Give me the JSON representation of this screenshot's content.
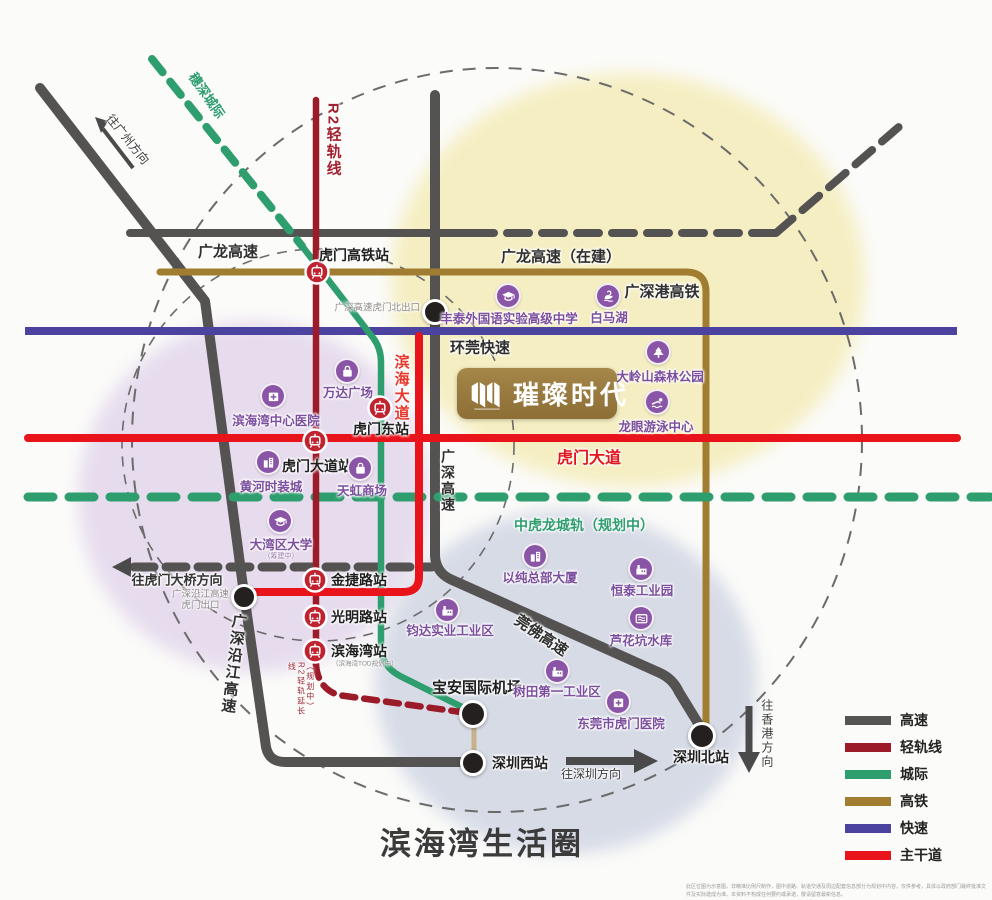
{
  "title": "滨海湾生活圈",
  "project": {
    "name": "璀璨时代"
  },
  "disclaimer": "此区位图为示意图，非精准比例尺制作，图中道路、轨道交通及周边配套信息部分为规划中内容，仅供参考，具体以政府部门最终批准文件及实际建成为准。本资料不构成任何要约或承诺，敬请留意最新信息。",
  "colors": {
    "highway": "#555252",
    "light_rail": "#9c1b29",
    "intercity": "#2e9e6e",
    "hsr": "#a07d30",
    "expressway": "#4c43a0",
    "arterial": "#e8131b",
    "poi": "#8a55a6",
    "poi_label": "#7b4e9e"
  },
  "road_labels": [
    {
      "id": "guanglong-expwy",
      "text": "广龙高速",
      "x": 228,
      "y": 252,
      "size": 15,
      "weight": "bold",
      "color": "#2f2f2f"
    },
    {
      "id": "guanglong-expwy-uc",
      "text": "广龙高速（在建）",
      "x": 561,
      "y": 257,
      "size": 15,
      "weight": "bold",
      "color": "#2f2f2f"
    },
    {
      "id": "r2-light-rail",
      "text": "R2轻轨线",
      "x": 333,
      "y": 140,
      "size": 15,
      "weight": "bold",
      "color": "#a3202e",
      "vertical": true
    },
    {
      "id": "suishen-intercity",
      "text": "穗深城际",
      "x": 206,
      "y": 96,
      "size": 13,
      "weight": "bold",
      "color": "#2f9e6e",
      "rot": 55
    },
    {
      "id": "to-guangzhou",
      "text": "往广州方向",
      "x": 127,
      "y": 140,
      "size": 12,
      "weight": "normal",
      "color": "#3c3c3c",
      "rot": 51
    },
    {
      "id": "huanwan-expwy",
      "text": "环莞快速",
      "x": 480,
      "y": 348,
      "size": 15,
      "weight": "bold",
      "color": "#2f2f2f"
    },
    {
      "id": "binhai-avenue",
      "text": "滨海大道",
      "x": 401,
      "y": 388,
      "size": 15,
      "weight": "bold",
      "color": "#e8362b",
      "vertical": true
    },
    {
      "id": "humen-avenue",
      "text": "虎门大道",
      "x": 589,
      "y": 459,
      "size": 16,
      "weight": "bold",
      "color": "#e0161c"
    },
    {
      "id": "guangshen-expwy",
      "text": "广深高速",
      "x": 448,
      "y": 481,
      "size": 14,
      "weight": "bold",
      "color": "#2f2f2f",
      "vertical": true
    },
    {
      "id": "zhonghulong-rail",
      "text": "中虎龙城轨（规划中）",
      "x": 584,
      "y": 525,
      "size": 14,
      "weight": "bold",
      "color": "#2f9e6e"
    },
    {
      "id": "guanfo-expwy",
      "text": "莞佛高速",
      "x": 541,
      "y": 636,
      "size": 15,
      "weight": "bold",
      "color": "#2f2f2f",
      "rot": 34
    },
    {
      "id": "yanjiang-expwy",
      "text": "广深沿江高速",
      "x": 233,
      "y": 664,
      "size": 15,
      "weight": "bold",
      "color": "#2f2f2f",
      "vertical": true,
      "rot": 7
    },
    {
      "id": "to-humen-bridge",
      "text": "往虎门大桥方向",
      "x": 177,
      "y": 581,
      "size": 13,
      "weight": "bold",
      "color": "#333333"
    },
    {
      "id": "to-shenzhen",
      "text": "往深圳方向",
      "x": 591,
      "y": 775,
      "size": 12,
      "weight": "normal",
      "color": "#3c3c3c"
    },
    {
      "id": "to-hongkong",
      "text": "往香港方向",
      "x": 766,
      "y": 734,
      "size": 12,
      "weight": "normal",
      "color": "#3c3c3c",
      "vertical": true
    },
    {
      "id": "guangshengang-hsr",
      "text": "广深港高铁",
      "x": 662,
      "y": 292,
      "size": 15,
      "weight": "bold",
      "color": "#2f2f2f"
    },
    {
      "id": "r2-extension",
      "text": "（规划中）R2轻轨延长线",
      "x": 301,
      "y": 690,
      "size": 8,
      "weight": "normal",
      "color": "#9c2733",
      "vertical": true,
      "h": 56
    }
  ],
  "stations": [
    {
      "id": "humen-hsr-station",
      "label": "虎门高铁站",
      "x": 317,
      "y": 272,
      "lx": 354,
      "ly": 255,
      "anchor": "c"
    },
    {
      "id": "humen-east-station",
      "label": "虎门东站",
      "x": 380,
      "y": 408,
      "lx": 381,
      "ly": 429,
      "anchor": "c"
    },
    {
      "id": "humen-avenue-station",
      "label": "虎门大道站",
      "x": 315,
      "y": 441,
      "lx": 317,
      "ly": 466,
      "anchor": "c"
    },
    {
      "id": "jinjie-road-station",
      "label": "金捷路站",
      "x": 315,
      "y": 580,
      "lx": 331,
      "ly": 580,
      "anchor": "l"
    },
    {
      "id": "guangming-road-station",
      "label": "光明路站",
      "x": 315,
      "y": 617,
      "lx": 331,
      "ly": 617,
      "anchor": "l"
    },
    {
      "id": "binhaiwan-station",
      "label": "滨海湾站",
      "x": 315,
      "y": 651,
      "lx": 331,
      "ly": 651,
      "anchor": "l",
      "sub": "（滨海湾TOD规划中）",
      "sx": 332,
      "sy": 664
    }
  ],
  "markers": [
    {
      "id": "humen-north-exit",
      "label": "广深高速虎门北出口",
      "x": 435,
      "y": 312,
      "r": 13,
      "lx": 420,
      "ly": 309,
      "anchor": "r",
      "lsize": 9.5,
      "lcolor": "#8f8b8b",
      "lweight": "normal"
    },
    {
      "id": "yanjiang-humen-exit",
      "label": "广深沿江高速\n虎门出口",
      "x": 244,
      "y": 597,
      "r": 13,
      "lx": 229,
      "ly": 601,
      "anchor": "r",
      "lsize": 9.5,
      "lcolor": "#8f8b8b",
      "lweight": "normal",
      "center": true
    },
    {
      "id": "baoan-airport",
      "label": "宝安国际机场",
      "x": 473,
      "y": 714,
      "r": 14,
      "lx": 477,
      "ly": 688,
      "anchor": "c",
      "lsize": 15,
      "lcolor": "#1e1e1e",
      "lweight": "bold"
    },
    {
      "id": "shenzhen-west-station",
      "label": "深圳西站",
      "x": 473,
      "y": 763,
      "r": 13,
      "lx": 492,
      "ly": 763,
      "anchor": "l",
      "lsize": 14,
      "lcolor": "#1e1e1e",
      "lweight": "bold"
    },
    {
      "id": "shenzhen-north-station",
      "label": "深圳北站",
      "x": 702,
      "y": 736,
      "r": 14,
      "lx": 701,
      "ly": 757,
      "anchor": "c",
      "lsize": 14,
      "lcolor": "#1e1e1e",
      "lweight": "bold"
    }
  ],
  "pois": [
    {
      "id": "fengtai-school",
      "icon": "school",
      "label": "丰泰外国语实验高级中学",
      "x": 508,
      "y": 296,
      "lx": 509,
      "ly": 319
    },
    {
      "id": "baimahu-lake",
      "icon": "bird",
      "label": "白马湖",
      "x": 608,
      "y": 296,
      "lx": 609,
      "ly": 318
    },
    {
      "id": "dalingshan-park",
      "icon": "tree",
      "label": "大岭山森林公园",
      "x": 658,
      "y": 352,
      "lx": 660,
      "ly": 377
    },
    {
      "id": "longyan-swim-center",
      "icon": "swimmer",
      "label": "龙眼游泳中心",
      "x": 657,
      "y": 402,
      "lx": 656,
      "ly": 427
    },
    {
      "id": "wanda-plaza",
      "icon": "bag",
      "label": "万达广场",
      "x": 347,
      "y": 371,
      "lx": 348,
      "ly": 393
    },
    {
      "id": "binhaiwan-hospital",
      "icon": "hospital",
      "label": "滨海湾中心医院",
      "x": 273,
      "y": 396,
      "lx": 276,
      "ly": 421
    },
    {
      "id": "huanghe-fashion-city",
      "icon": "building",
      "label": "黄河时装城",
      "x": 268,
      "y": 462,
      "lx": 271,
      "ly": 487
    },
    {
      "id": "tianhong-mall",
      "icon": "bag",
      "label": "天虹商场",
      "x": 360,
      "y": 468,
      "lx": 362,
      "ly": 491
    },
    {
      "id": "greater-bay-university",
      "icon": "school",
      "label": "大湾区大学",
      "x": 280,
      "y": 521,
      "lx": 281,
      "ly": 545,
      "sub": "（筹建中）",
      "sx": 281,
      "sy": 557
    },
    {
      "id": "yichun-hq-tower",
      "icon": "building",
      "label": "以纯总部大厦",
      "x": 535,
      "y": 556,
      "lx": 540,
      "ly": 578
    },
    {
      "id": "hengtai-industrial-park",
      "icon": "factory",
      "label": "恒泰工业园",
      "x": 641,
      "y": 569,
      "lx": 642,
      "ly": 591
    },
    {
      "id": "luhuakeng-reservoir",
      "icon": "water",
      "label": "芦花坑水库",
      "x": 641,
      "y": 618,
      "lx": 641,
      "ly": 641
    },
    {
      "id": "junda-industrial-zone",
      "icon": "factory",
      "label": "钧达实业工业区",
      "x": 447,
      "y": 610,
      "lx": 450,
      "ly": 631
    },
    {
      "id": "shutian-first-industrial-zone",
      "icon": "factory",
      "label": "树田第一工业区",
      "x": 557,
      "y": 671,
      "lx": 557,
      "ly": 692
    },
    {
      "id": "dongguan-humen-hospital",
      "icon": "hospital",
      "label": "东莞市虎门医院",
      "x": 618,
      "y": 702,
      "lx": 621,
      "ly": 724
    }
  ],
  "legend": {
    "items": [
      {
        "label": "高速",
        "color": "#565353"
      },
      {
        "label": "轻轨线",
        "color": "#9c1b29"
      },
      {
        "label": "城际",
        "color": "#2e9e6e"
      },
      {
        "label": "高铁",
        "color": "#a07d30"
      },
      {
        "label": "快速",
        "color": "#4c43a0"
      },
      {
        "label": "主干道",
        "color": "#e8131b"
      }
    ]
  }
}
